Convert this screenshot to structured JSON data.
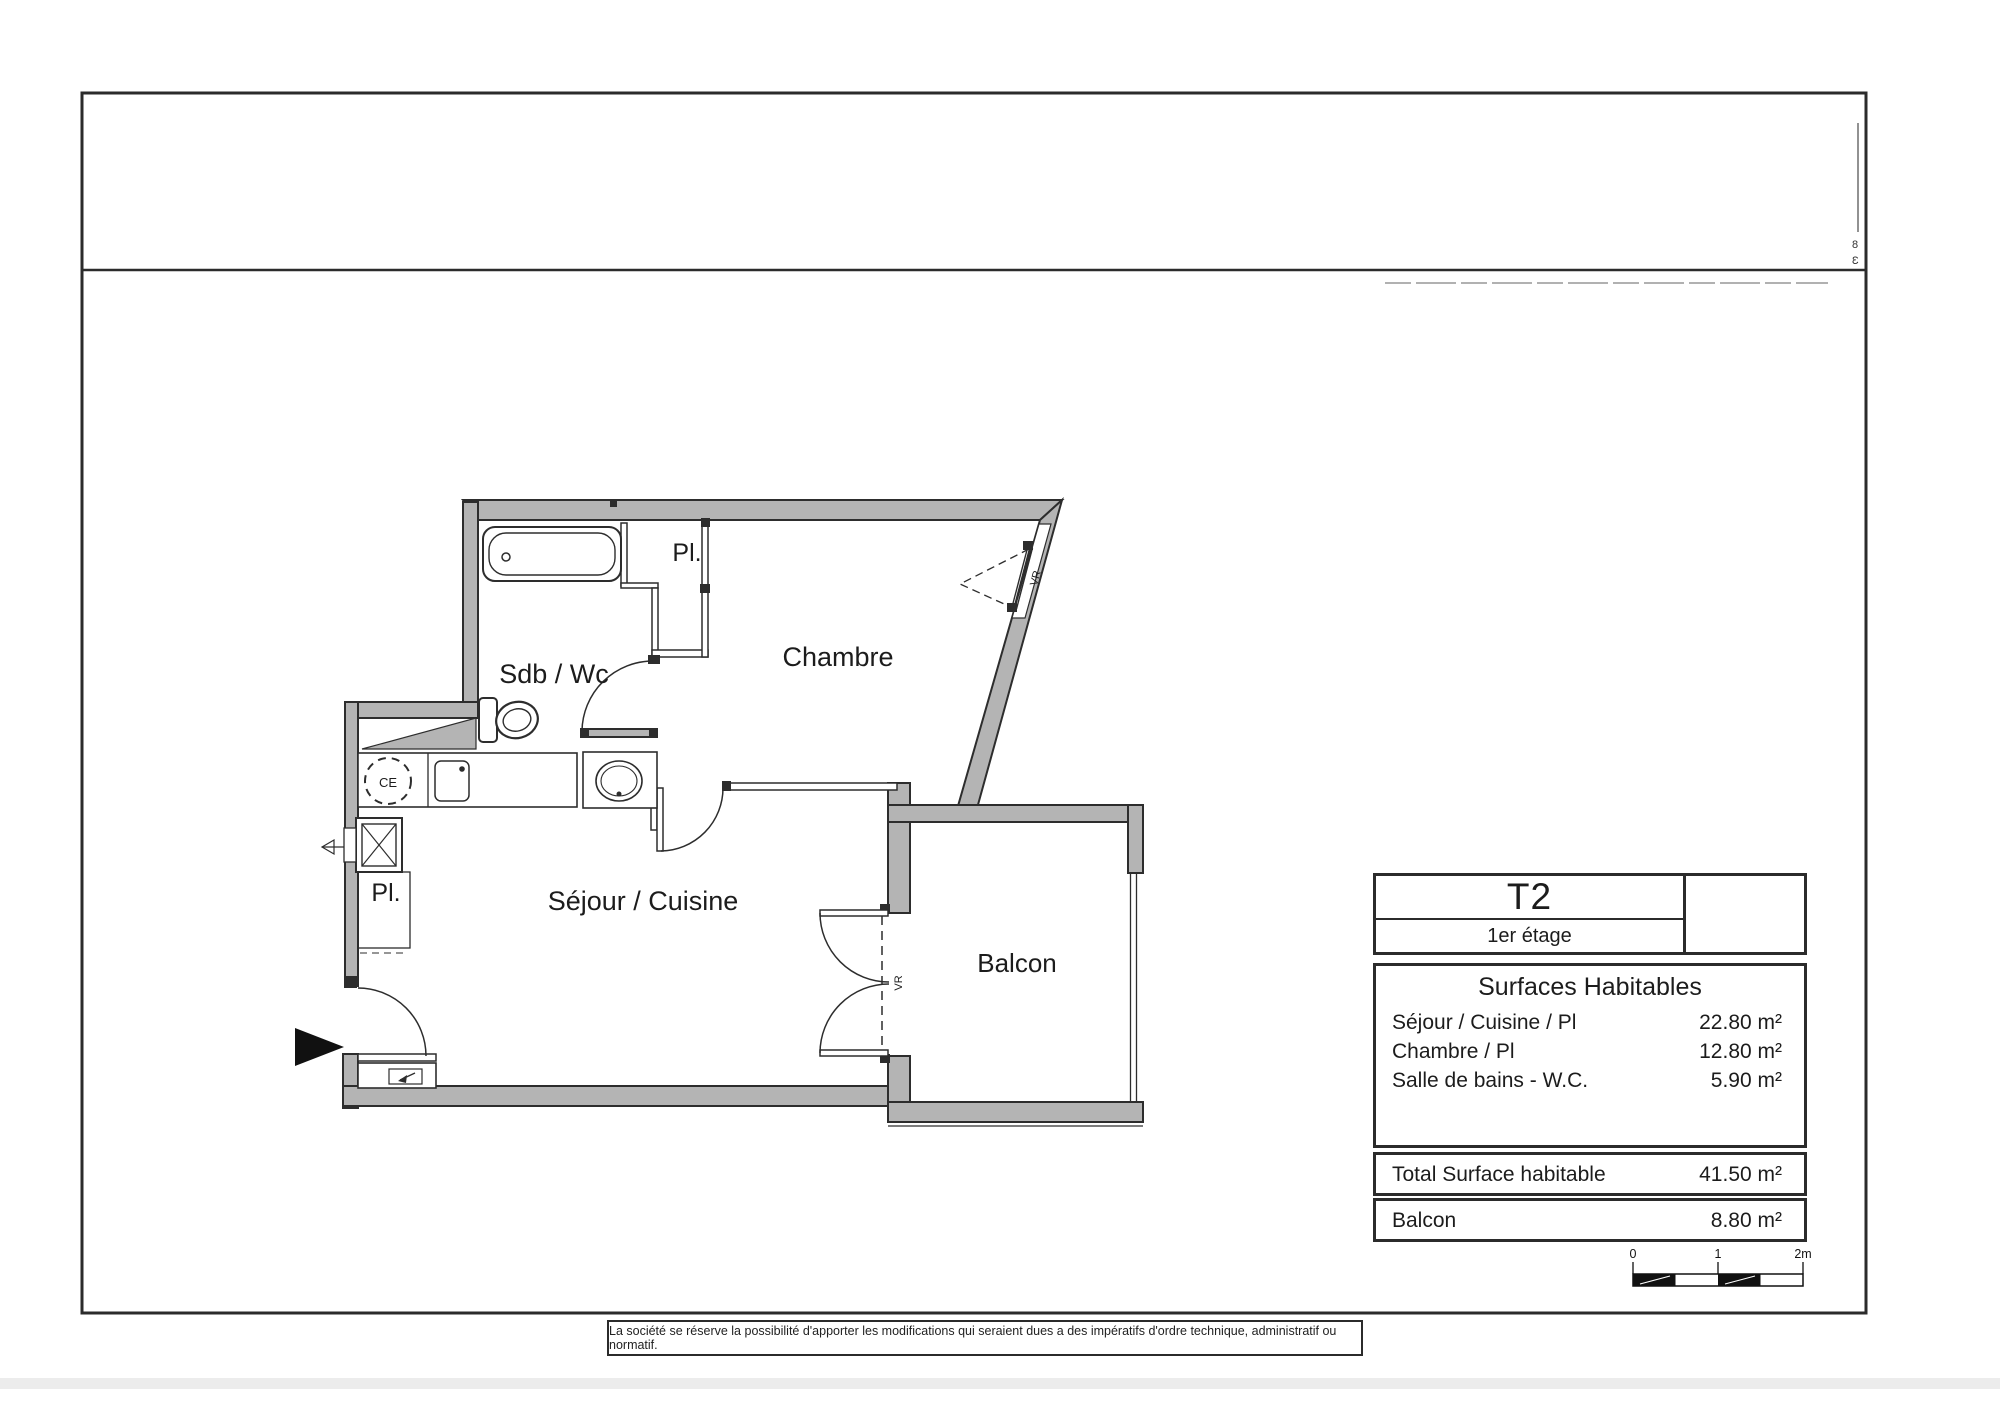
{
  "plan": {
    "rooms": {
      "sdb": "Sdb / Wc",
      "chambre": "Chambre",
      "sejour": "Séjour / Cuisine",
      "balcon": "Balcon",
      "placard_top": "Pl.",
      "placard_bottom": "Pl."
    },
    "fixtures": {
      "water_heater": "CE"
    },
    "shutter_label": "VR"
  },
  "title_block": {
    "unit_type": "T2",
    "floor": "1er étage"
  },
  "surfaces": {
    "title": "Surfaces Habitables",
    "rows": [
      {
        "label": "Séjour / Cuisine / Pl",
        "value": "22.80 m²"
      },
      {
        "label": "Chambre / Pl",
        "value": "12.80 m²"
      },
      {
        "label": "Salle de bains - W.C.",
        "value": "5.90 m²"
      }
    ],
    "total_label": "Total Surface habitable",
    "total_value": "41.50 m²",
    "balcony_label": "Balcon",
    "balcony_value": "8.80 m²"
  },
  "scale_bar": {
    "tick0": "0",
    "tick1": "1",
    "tick2": "2m"
  },
  "footer": {
    "disclaimer": "La société se réserve la possibilité d'apporter les modifications qui seraient dues a des impératifs d'ordre technique, administratif ou normatif."
  },
  "margin_notes": {
    "top": "8",
    "bottom": "Ɛ"
  },
  "colors": {
    "wall_fill": "#b4b4b4",
    "line": "#2d2d2d"
  }
}
